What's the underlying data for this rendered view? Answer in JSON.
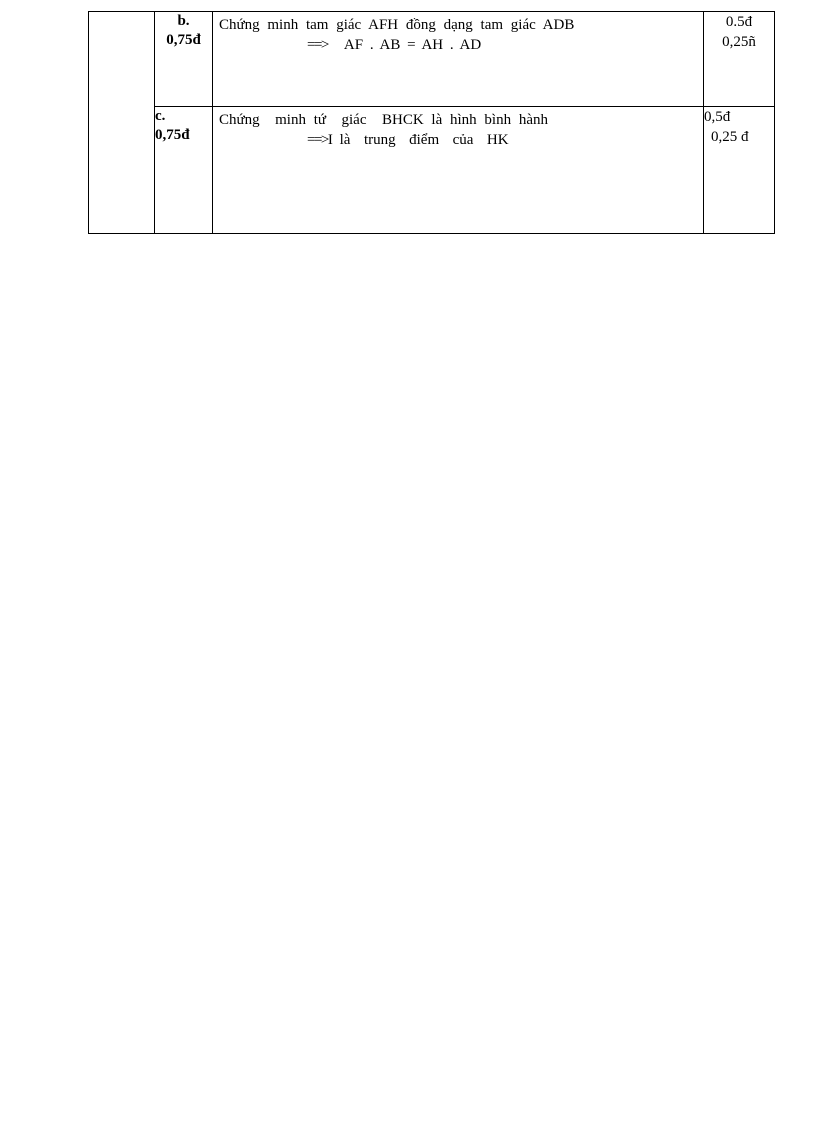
{
  "document": {
    "background_color": "#ffffff",
    "text_color": "#000000",
    "border_color": "#000000"
  },
  "table": {
    "rows": [
      {
        "item": "b.",
        "item_points": "0,75đ",
        "statement": "Chứng minh tam giác AFH đồng dạng tam giác ADB",
        "arrow": "==>",
        "derivation": "AF . AB = AH . AD",
        "points_line1": "0.5đ",
        "points_line2": "0,25ñ"
      },
      {
        "item": "c.",
        "item_points": "0,75đ",
        "statement": "Chứng  minh tứ  giác  BHCK là hình bình hành",
        "arrow": "==>",
        "derivation": "I là  trung  điểm  của  HK",
        "points_line1": "0,5đ",
        "points_line2": "0,25 đ"
      }
    ]
  }
}
